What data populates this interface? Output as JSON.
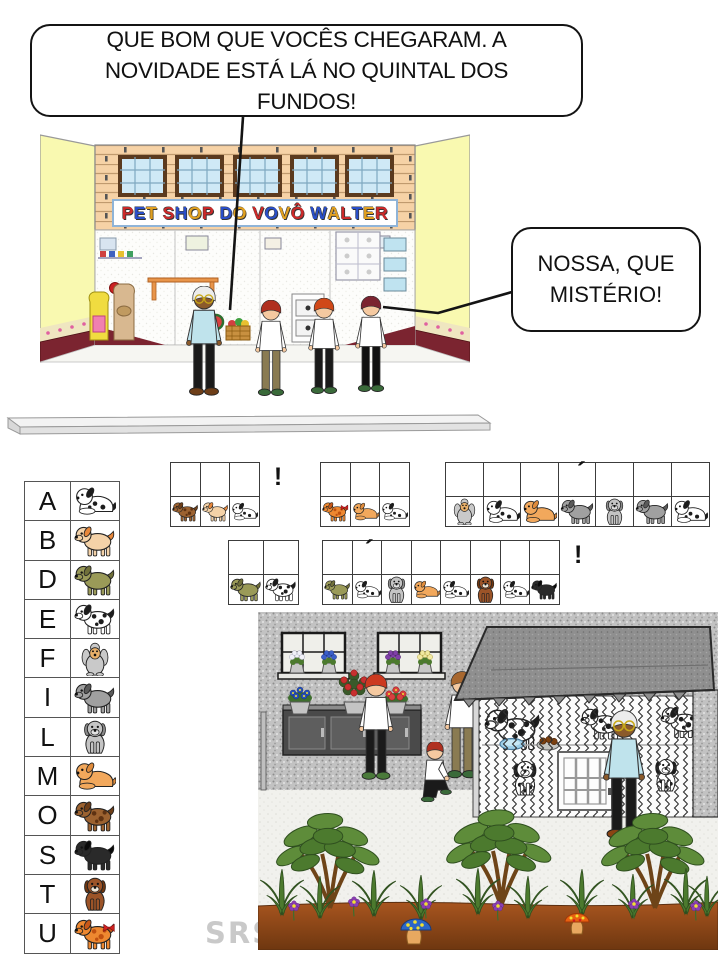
{
  "bubbles": {
    "top": "QUE BOM QUE VOCÊS  CHEGARAM. A NOVIDADE ESTÁ LÁ NO QUINTAL DOS FUNDOS!",
    "right": "NOSSA, QUE MISTÉRIO!"
  },
  "shop": {
    "sign": "PET SHOP DO VOVÔ WALTER",
    "sign_colors": [
      "#CC2A2A",
      "#2A4FC8",
      "#E0A020"
    ]
  },
  "key": {
    "letters": [
      "A",
      "B",
      "D",
      "E",
      "F",
      "I",
      "L",
      "M",
      "O",
      "S",
      "T",
      "U"
    ],
    "dogs": {
      "A": "white dog with black patches lying",
      "B": "tan dog with orange ears",
      "D": "olive-green dog standing",
      "E": "white dog with black spots",
      "F": "gray poodle with tan face",
      "I": "gray dog walking",
      "L": "gray schnauzer sitting",
      "M": "golden puppy lying",
      "O": "brown spotted dog",
      "S": "black dog standing",
      "T": "brown hound with white muzzle sitting",
      "U": "orange spotted puppy with red bow"
    }
  },
  "cryptogram": {
    "accent_mark": "´",
    "words": [
      {
        "letters": [
          "O",
          "B",
          "A"
        ],
        "suffix": "!"
      },
      {
        "letters": [
          "U",
          "M",
          "A"
        ]
      },
      {
        "letters": [
          "F",
          "A",
          "M",
          "I",
          "L",
          "I",
          "A"
        ],
        "accent_index": 3
      },
      {
        "letters": [
          "D",
          "E"
        ]
      },
      {
        "letters": [
          "D",
          "A",
          "L",
          "M",
          "A",
          "T",
          "A",
          "S"
        ],
        "accent_index": 1,
        "suffix": "!"
      }
    ]
  },
  "watermark": "SRS"
}
